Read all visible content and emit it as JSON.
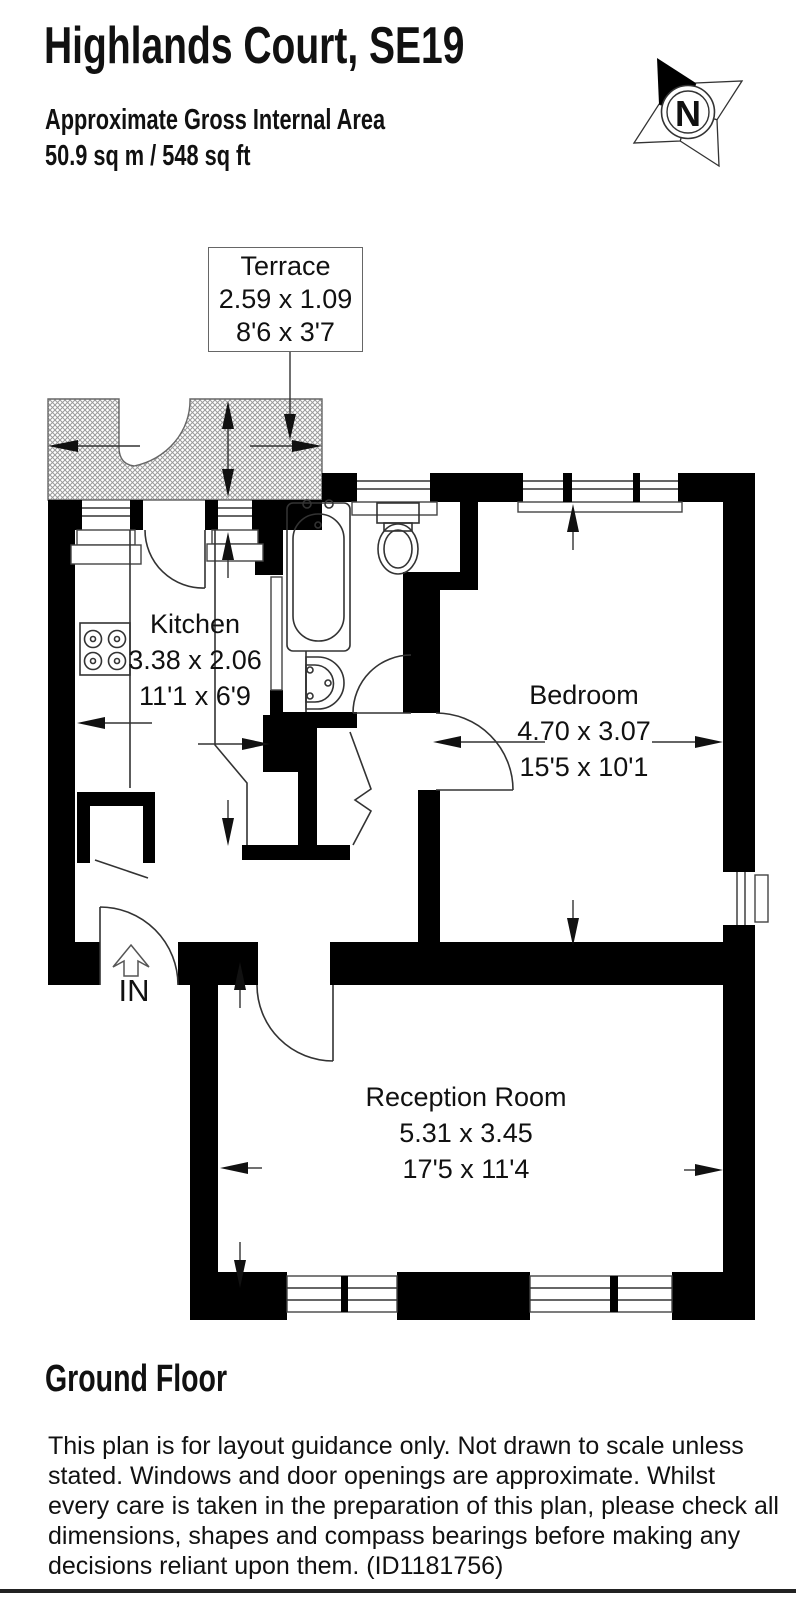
{
  "header": {
    "title": "Highlands Court, SE19",
    "area_label": "Approximate Gross Internal Area",
    "area_value": "50.9 sq m / 548 sq ft"
  },
  "compass": {
    "north_label": "N"
  },
  "rooms": {
    "terrace": {
      "name": "Terrace",
      "metric": "2.59 x 1.09",
      "imperial": "8'6 x 3'7"
    },
    "kitchen": {
      "name": "Kitchen",
      "metric": "3.38 x 2.06",
      "imperial": "11'1 x 6'9"
    },
    "bedroom": {
      "name": "Bedroom",
      "metric": "4.70 x 3.07",
      "imperial": "15'5 x 10'1"
    },
    "reception_room": {
      "name": "Reception Room",
      "metric": "5.31 x 3.45",
      "imperial": "17'5 x 11'4"
    }
  },
  "entrance": {
    "label": "IN"
  },
  "footer": {
    "floor_label": "Ground Floor",
    "disclaimer_lines": [
      "This plan is for layout guidance only. Not drawn to scale unless",
      "stated. Windows and door openings are approximate. Whilst",
      "every care is taken in the preparation of this plan, please check all",
      "dimensions, shapes and compass bearings before making any",
      "decisions reliant upon them. (ID1181756)"
    ]
  },
  "colors": {
    "wall": "#000000",
    "line": "#333333",
    "hatch": "#9a9a9a",
    "text": "#111111"
  }
}
